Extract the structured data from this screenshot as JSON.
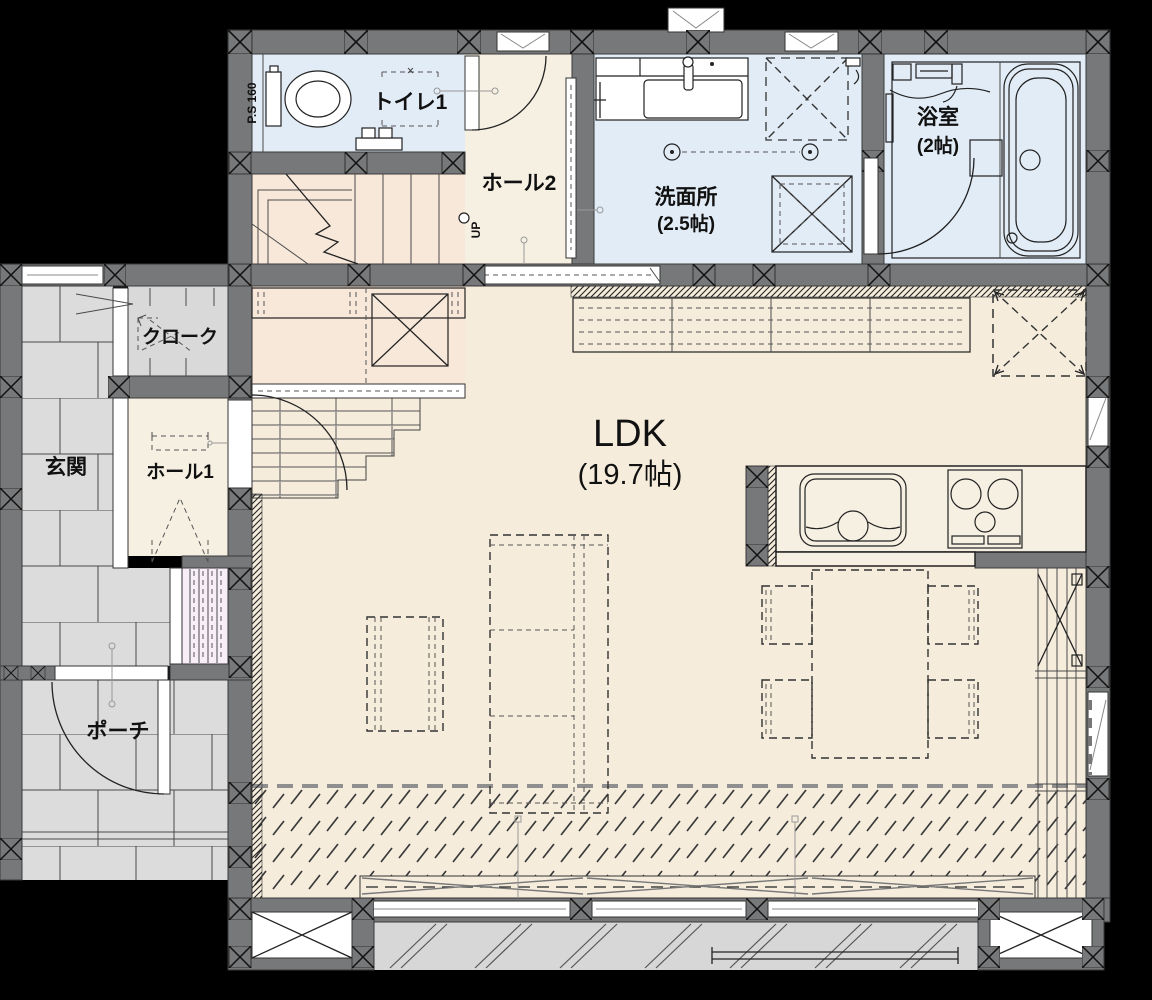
{
  "colors": {
    "background": "#000000",
    "wall": "#77787a",
    "floor-blue": "#e2ecf6",
    "floor-cream": "#f6f0e3",
    "floor-ldk": "#f5ecdc",
    "floor-peach": "#f8e8da",
    "floor-tile": "#dcdcdd",
    "floor-cloak": "#d9d9d9",
    "pink": "#f8eef8",
    "deck": "#d7d7d7",
    "counter": "#f6f0e2",
    "line": "#222222"
  },
  "rooms": {
    "ps": {
      "label": "P.S 160"
    },
    "toilet": {
      "label": "トイレ1"
    },
    "hall2": {
      "label": "ホール2"
    },
    "washroom": {
      "label": "洗面所",
      "size": "(2.5帖)"
    },
    "bathroom": {
      "label": "浴室",
      "size": "(2帖)"
    },
    "cloak": {
      "label": "クローク"
    },
    "entrance": {
      "label": "玄関"
    },
    "hall1": {
      "label": "ホール1"
    },
    "porch": {
      "label": "ポーチ"
    },
    "ldk": {
      "label": "LDK",
      "size": "(19.7帖)"
    },
    "stairs": {
      "direction": "UP"
    }
  }
}
